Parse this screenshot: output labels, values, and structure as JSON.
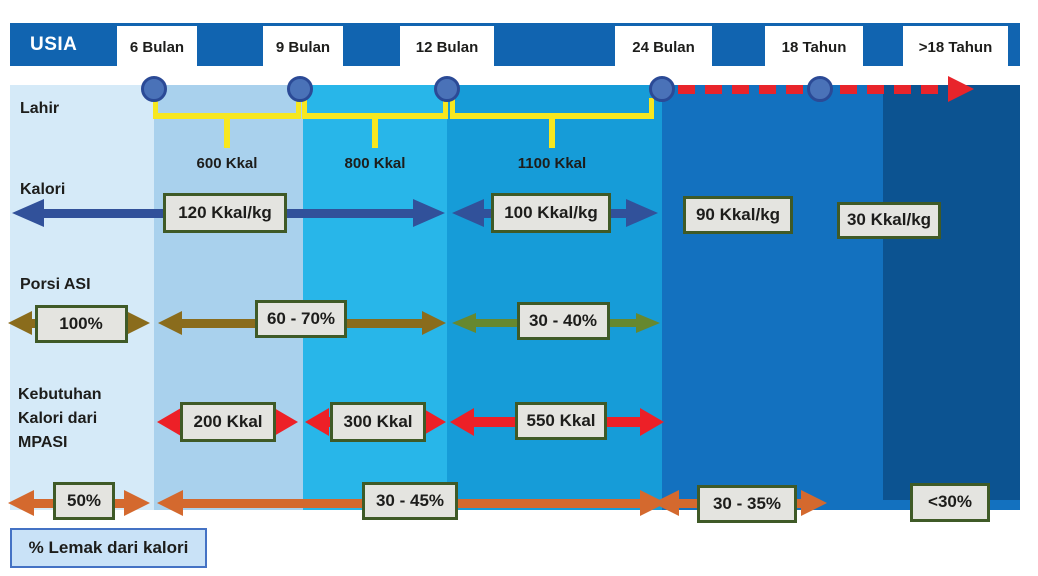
{
  "title_bar": {
    "label": "USIA"
  },
  "legend": {
    "label": "% Lemak dari kalori"
  },
  "colors": {
    "header_bar": "#1164b0",
    "text": "#1d1d1b",
    "yellow": "#f7e71f",
    "red_dash": "#e8242b",
    "circle_fill": "#4a72b8",
    "circle_border": "#2b4a96",
    "box_fill": "#e4e4e0",
    "box_border": "#3f5a27",
    "legend_fill": "#c9e2f7",
    "legend_border": "#4472c4",
    "navy_arrow": "#31519a",
    "brown_arrow": "#8a6c1c",
    "green_arrow": "#66882f",
    "red_arrow": "#ed2027",
    "orange_arrow": "#d4692e"
  },
  "age_labels": [
    {
      "label": "6 Bulan",
      "x": 117,
      "w": 80
    },
    {
      "label": "9 Bulan",
      "x": 263,
      "w": 80
    },
    {
      "label": "12 Bulan",
      "x": 400,
      "w": 94
    },
    {
      "label": "24 Bulan",
      "x": 615,
      "w": 97
    },
    {
      "label": "18 Tahun",
      "x": 765,
      "w": 98
    },
    {
      "label": ">18 Tahun",
      "x": 903,
      "w": 105
    }
  ],
  "bands": [
    {
      "x": 10,
      "w": 144,
      "h": 425,
      "color": "#d5eaf8"
    },
    {
      "x": 154,
      "w": 149,
      "h": 425,
      "color": "#a9d1ed"
    },
    {
      "x": 303,
      "w": 144,
      "h": 425,
      "color": "#28b6e9"
    },
    {
      "x": 447,
      "w": 215,
      "h": 425,
      "color": "#169cd8"
    },
    {
      "x": 662,
      "w": 358,
      "h": 425,
      "color": "#1371bf"
    },
    {
      "x": 883,
      "w": 137,
      "h": 415,
      "color": "#0c5391"
    }
  ],
  "timeline": {
    "circles_x": [
      154,
      300,
      447,
      662,
      820
    ],
    "circle_cy": 89,
    "dash": {
      "x1": 678,
      "x2": 950,
      "y": 89,
      "head_len": 26,
      "head_h": 26
    }
  },
  "brackets": [
    {
      "x1": 155,
      "x2": 299,
      "label": "600 Kkal"
    },
    {
      "x1": 304,
      "x2": 446,
      "label": "800 Kkal"
    },
    {
      "x1": 452,
      "x2": 652,
      "label": "1100 Kkal"
    }
  ],
  "row_labels": [
    {
      "text": "Lahir",
      "x": 20,
      "y": 97
    },
    {
      "text": "Kalori",
      "x": 20,
      "y": 178
    },
    {
      "text": "Porsi ASI",
      "x": 20,
      "y": 273
    },
    {
      "text": "Kebutuhan\nKalori dari\nMPASI",
      "x": 18,
      "y": 383
    }
  ],
  "arrows": [
    {
      "row": "kalori",
      "color_key": "navy_arrow",
      "x1": 12,
      "x2": 445,
      "y": 213,
      "t": 9,
      "hl": 32,
      "hh": 28
    },
    {
      "row": "kalori",
      "color_key": "navy_arrow",
      "x1": 452,
      "x2": 658,
      "y": 213,
      "t": 9,
      "hl": 32,
      "hh": 28
    },
    {
      "row": "porsi-asi",
      "color_key": "brown_arrow",
      "x1": 8,
      "x2": 150,
      "y": 323,
      "t": 9,
      "hl": 24,
      "hh": 24
    },
    {
      "row": "porsi-asi",
      "color_key": "brown_arrow",
      "x1": 158,
      "x2": 446,
      "y": 323,
      "t": 9,
      "hl": 24,
      "hh": 24
    },
    {
      "row": "porsi-asi",
      "color_key": "green_arrow",
      "x1": 452,
      "x2": 660,
      "y": 323,
      "t": 8,
      "hl": 24,
      "hh": 20
    },
    {
      "row": "mpasi",
      "color_key": "red_arrow",
      "x1": 157,
      "x2": 298,
      "y": 422,
      "t": 10,
      "hl": 24,
      "hh": 28
    },
    {
      "row": "mpasi",
      "color_key": "red_arrow",
      "x1": 305,
      "x2": 446,
      "y": 422,
      "t": 10,
      "hl": 24,
      "hh": 28
    },
    {
      "row": "mpasi",
      "color_key": "red_arrow",
      "x1": 450,
      "x2": 664,
      "y": 422,
      "t": 10,
      "hl": 24,
      "hh": 28
    },
    {
      "row": "lemak",
      "color_key": "orange_arrow",
      "x1": 8,
      "x2": 150,
      "y": 503,
      "t": 9,
      "hl": 26,
      "hh": 26
    },
    {
      "row": "lemak",
      "color_key": "orange_arrow",
      "x1": 157,
      "x2": 666,
      "y": 503,
      "t": 9,
      "hl": 26,
      "hh": 26
    },
    {
      "row": "lemak",
      "color_key": "orange_arrow",
      "x1": 653,
      "x2": 827,
      "y": 503,
      "t": 9,
      "hl": 26,
      "hh": 26
    }
  ],
  "value_boxes": [
    {
      "row": "kalori",
      "text": "120 Kkal/kg",
      "cx": 225,
      "cy": 213,
      "w": 124,
      "h": 40
    },
    {
      "row": "kalori",
      "text": "100 Kkal/kg",
      "cx": 551,
      "cy": 213,
      "w": 120,
      "h": 40
    },
    {
      "row": "kalori",
      "text": "90 Kkal/kg",
      "cx": 738,
      "cy": 215,
      "w": 110,
      "h": 38
    },
    {
      "row": "kalori",
      "text": "30 Kkal/kg",
      "cx": 889,
      "cy": 220,
      "w": 104,
      "h": 37
    },
    {
      "row": "porsi-asi",
      "text": "100%",
      "cx": 81,
      "cy": 324,
      "w": 93,
      "h": 38
    },
    {
      "row": "porsi-asi",
      "text": "60 - 70%",
      "cx": 301,
      "cy": 319,
      "w": 92,
      "h": 38
    },
    {
      "row": "porsi-asi",
      "text": "30 - 40%",
      "cx": 563,
      "cy": 321,
      "w": 93,
      "h": 38
    },
    {
      "row": "mpasi",
      "text": "200 Kkal",
      "cx": 228,
      "cy": 422,
      "w": 96,
      "h": 40
    },
    {
      "row": "mpasi",
      "text": "300 Kkal",
      "cx": 378,
      "cy": 422,
      "w": 96,
      "h": 40
    },
    {
      "row": "mpasi",
      "text": "550 Kkal",
      "cx": 561,
      "cy": 421,
      "w": 92,
      "h": 38
    },
    {
      "row": "lemak",
      "text": "50%",
      "cx": 84,
      "cy": 501,
      "w": 62,
      "h": 38
    },
    {
      "row": "lemak",
      "text": "30 - 45%",
      "cx": 410,
      "cy": 501,
      "w": 96,
      "h": 38
    },
    {
      "row": "lemak",
      "text": "30 - 35%",
      "cx": 747,
      "cy": 504,
      "w": 100,
      "h": 38
    },
    {
      "row": "lemak",
      "text": "<30%",
      "cx": 950,
      "cy": 502,
      "w": 80,
      "h": 39
    }
  ]
}
